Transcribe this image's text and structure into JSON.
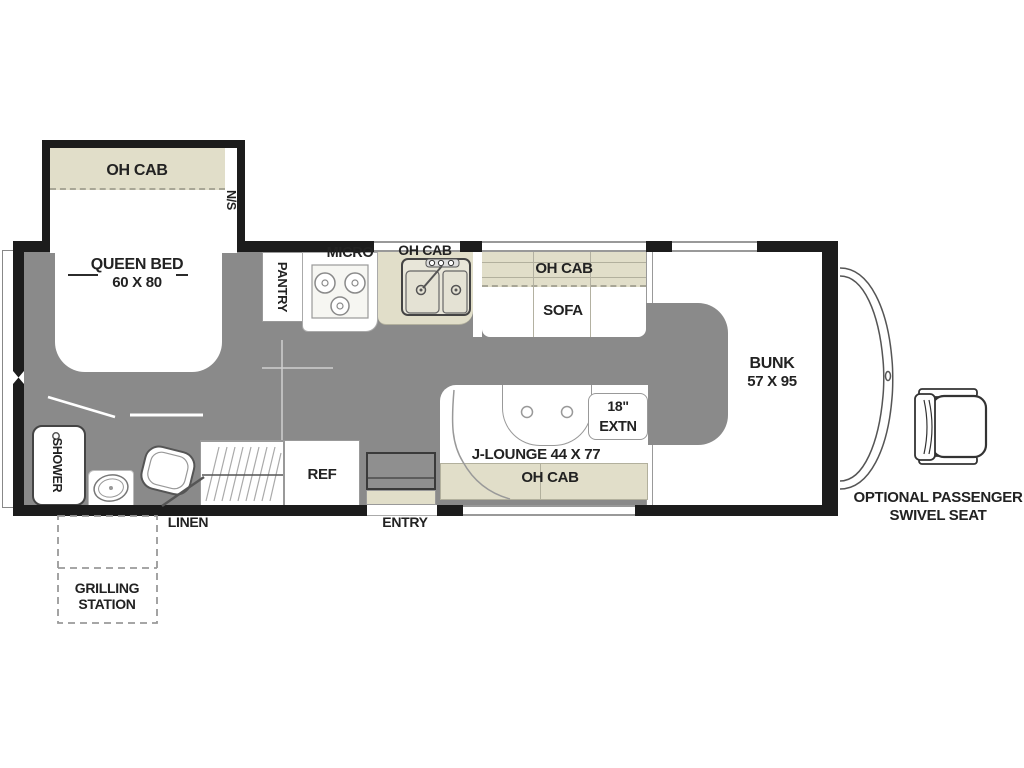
{
  "colors": {
    "floor": "#8a8a8a",
    "cabinet_tan": "#e1dec9",
    "wall": "#1c1c1c",
    "thin_line": "#999999",
    "text": "#222222"
  },
  "plan": {
    "bedroom": {
      "oh_cab": "OH CAB",
      "night_stand": "N/S",
      "queen_bed": "QUEEN BED",
      "queen_bed_size": "60 X 80"
    },
    "kitchen": {
      "pantry": "PANTRY",
      "micro": "MICRO",
      "oh_cab": "OH CAB",
      "fridge": "REF"
    },
    "living": {
      "oh_cab_top": "OH CAB",
      "sofa": "SOFA",
      "j_lounge": "J-LOUNGE 44 X 77",
      "table_extn_size": "18\"",
      "table_extn": "EXTN",
      "oh_cab_bottom": "OH CAB"
    },
    "bath": {
      "shower": "SHOWER",
      "linen": "LINEN"
    },
    "cabover": {
      "bunk": "BUNK",
      "bunk_size": "57 X 95"
    },
    "exterior": {
      "entry": "ENTRY",
      "grilling_1": "GRILLING",
      "grilling_2": "STATION",
      "swivel_1": "OPTIONAL PASSENGER",
      "swivel_2": "SWIVEL SEAT"
    }
  }
}
